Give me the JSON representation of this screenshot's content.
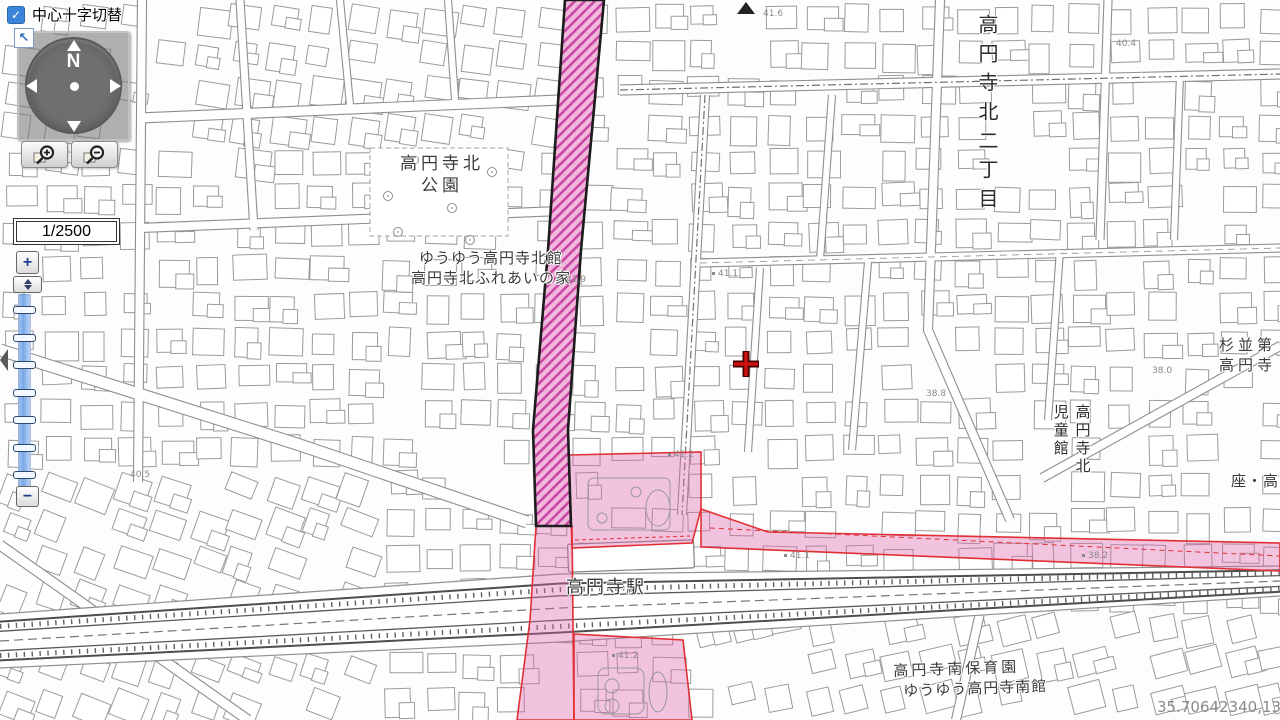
{
  "controls": {
    "crosshair_toggle": {
      "label": "中心十字切替",
      "checked": true,
      "icon": "checkbox-checked-icon"
    },
    "compass": {
      "north": "N",
      "icons": [
        "pan-up-arrow-icon",
        "pan-down-arrow-icon",
        "pan-left-arrow-icon",
        "pan-right-arrow-icon",
        "compass-center-dot-icon"
      ]
    },
    "pan_reset_icon": "northwest-arrow-icon",
    "magnifier_buttons": {
      "zoom_in_icon": "magnifier-plus-icon",
      "zoom_out_icon": "magnifier-minus-icon"
    },
    "scale": {
      "value": "1/2500"
    },
    "zoom_slider": {
      "plus": "+",
      "minus": "−",
      "tick_count": 7,
      "handle_icon": "up-down-triangles-icon"
    },
    "panel_collapse_icon": "left-triangle-icon"
  },
  "status": {
    "coordinates": "35.70642340,139.6"
  },
  "map": {
    "place_labels": [
      {
        "name": "koenji-kita-park",
        "lines": [
          "高円寺北",
          "公園"
        ],
        "x": 383,
        "y": 153,
        "size": 17,
        "spacing": 4,
        "width": 118,
        "align": "center"
      },
      {
        "name": "yuyu-koenji-kita-kan",
        "lines": [
          "ゆうゆう高円寺北館",
          "高円寺北ふれあいの家"
        ],
        "x": 396,
        "y": 249,
        "size": 15,
        "spacing": 1,
        "width": 190,
        "align": "center"
      },
      {
        "name": "koenji-station",
        "lines": [
          "高円寺駅"
        ],
        "x": 566,
        "y": 576,
        "size": 18,
        "spacing": 2
      },
      {
        "name": "koenji-kita-2-chome",
        "text": "高円寺北二丁目",
        "vertical": true,
        "x": 971,
        "y": 14,
        "size": 20,
        "spacing": 9
      },
      {
        "name": "suginami-dai-koenji",
        "lines": [
          "杉並第",
          "高円寺"
        ],
        "x": 1219,
        "y": 336,
        "size": 15,
        "spacing": 4
      },
      {
        "name": "koenji-kita-jidokan",
        "text": "高円寺北\n児童館",
        "vertical": true,
        "x": 1049,
        "y": 404,
        "size": 15,
        "spacing": 3
      },
      {
        "name": "za-koenji",
        "lines": [
          "座・高円寺"
        ],
        "x": 1231,
        "y": 472,
        "size": 15,
        "spacing": 1
      },
      {
        "name": "koenji-minami-hoikuen",
        "lines": [
          "高円寺南保育園"
        ],
        "x": 893,
        "y": 662,
        "size": 15,
        "spacing": 3,
        "rotate": -2
      },
      {
        "name": "yuyu-koenji-minami-kan",
        "lines": [
          "ゆうゆう高円寺南館"
        ],
        "x": 903,
        "y": 682,
        "size": 15,
        "spacing": 1,
        "rotate": -2
      }
    ],
    "elevation_labels": [
      {
        "v": "41.6",
        "x": 763,
        "y": 9
      },
      {
        "v": "40.4",
        "x": 1116,
        "y": 39
      },
      {
        "v": "41.1",
        "x": 712,
        "y": 269,
        "dot": true
      },
      {
        "v": "41.9",
        "x": 566,
        "y": 275
      },
      {
        "v": "38.0",
        "x": 1152,
        "y": 366
      },
      {
        "v": "38.8",
        "x": 926,
        "y": 389
      },
      {
        "v": "40.5",
        "x": 130,
        "y": 470
      },
      {
        "v": "41.2",
        "x": 668,
        "y": 450,
        "dot": true
      },
      {
        "v": "41.1",
        "x": 784,
        "y": 551,
        "dot": true
      },
      {
        "v": "38.2",
        "x": 1082,
        "y": 551,
        "dot": true
      },
      {
        "v": "41.2",
        "x": 612,
        "y": 651,
        "dot": true
      }
    ]
  },
  "colors": {
    "corridor_hatch_fill": "#f2b3da",
    "corridor_hatch_line": "#c43a9e",
    "corridor_border": "#1c1c1c",
    "zone_fill": "#e064ae",
    "zone_border": "#e03034",
    "building_stroke": "#9b9b9b",
    "road_edge": "#8f8f8f",
    "railway": "#4d4d4d",
    "crosshair_red": "#cc1111",
    "ui_blue": "#3a85d9"
  }
}
